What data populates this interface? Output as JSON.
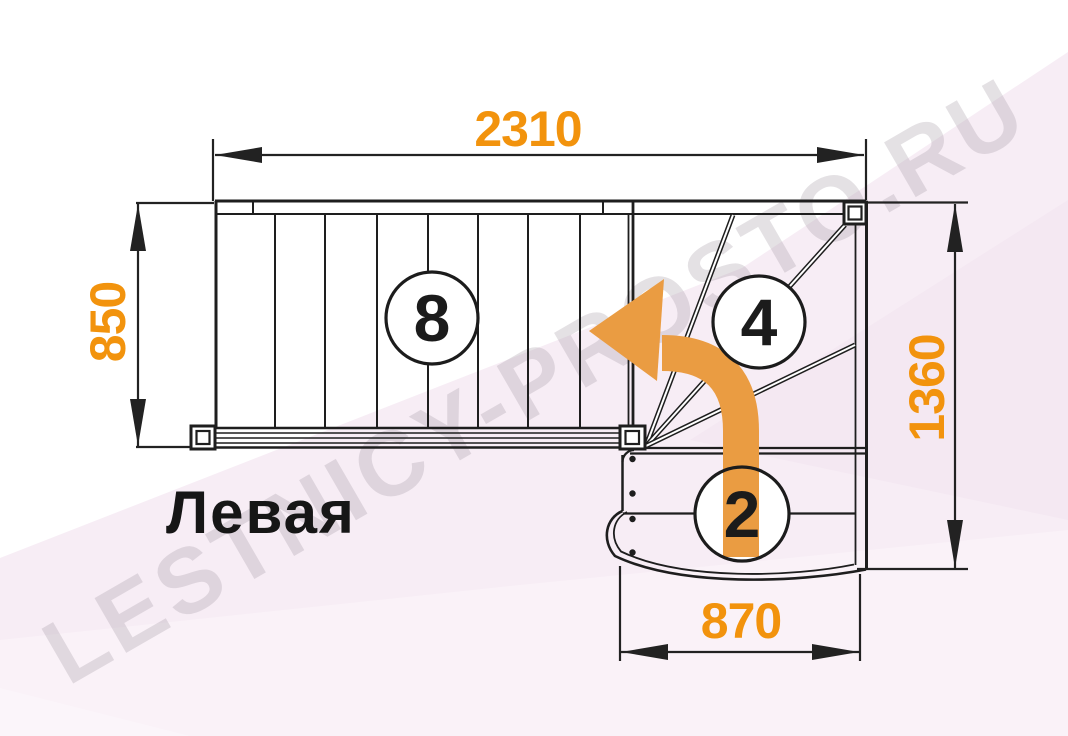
{
  "diagram": {
    "title": "Левая",
    "watermark": "LESTNICY-PROSTO.RU",
    "dimensions": {
      "top_width": "2310",
      "left_height": "850",
      "right_height": "1360",
      "bottom_width": "870"
    },
    "flights": {
      "upper_steps": "8",
      "winder_steps": "4",
      "lower_steps": "2"
    },
    "colors": {
      "dimension_text": "#F2930D",
      "direction_arrow": "#EA9C42",
      "linework": "#1E1E1E",
      "background": "#FFFFFF",
      "background_accent": "#F7EDF5",
      "watermark_gray": "#E7E2E7"
    }
  }
}
